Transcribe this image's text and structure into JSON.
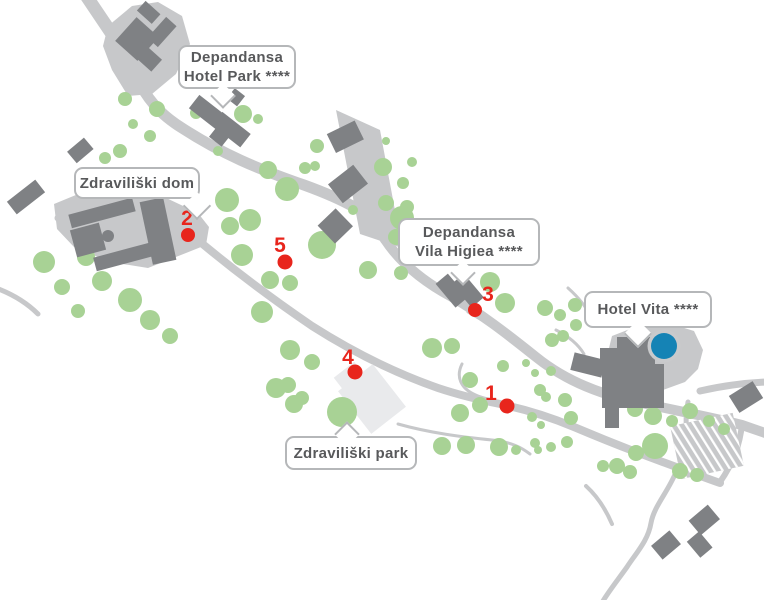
{
  "callouts": {
    "hotel_park": {
      "line1": "Depandansa",
      "line2": "Hotel Park ****"
    },
    "zdraviliski_dom": {
      "label": "Zdraviliški dom"
    },
    "vila_higiea": {
      "line1": "Depandansa",
      "line2": "Vila Higiea ****"
    },
    "hotel_vita": {
      "label": "Hotel Vita ****"
    },
    "zdraviliski_park": {
      "label": "Zdraviliški park"
    }
  },
  "markers": [
    {
      "number": "1"
    },
    {
      "number": "2"
    },
    {
      "number": "3"
    },
    {
      "number": "4"
    },
    {
      "number": "5"
    }
  ],
  "colors": {
    "road": "#c7c8ca",
    "building": "#7f8184",
    "tree": "#a8d295",
    "marker_red": "#e8251c",
    "pool_blue": "#1583b5",
    "pool_ring": "#c9cacc",
    "park_building": "#e9eaec",
    "callout_border": "#b5b7b9",
    "callout_text": "#58595b"
  }
}
